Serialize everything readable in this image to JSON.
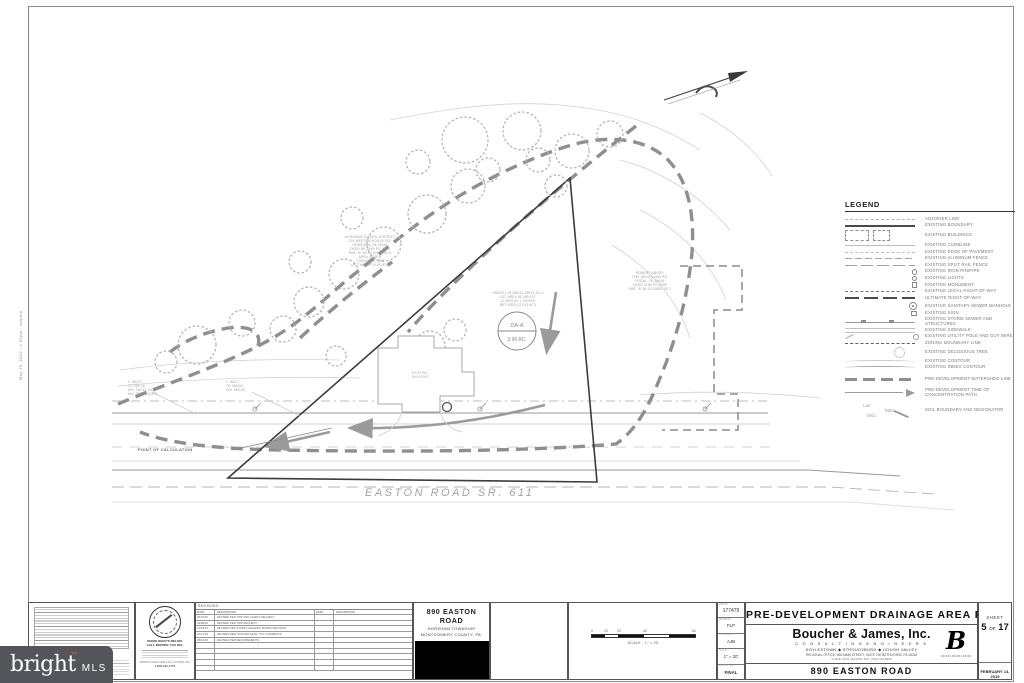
{
  "plan": {
    "road_label": "EASTON ROAD SR. 611",
    "poc_label": "POINT OF CALCULATION",
    "building": {
      "l1": "EXISTING",
      "l2": "BUILDING"
    },
    "da_circle": {
      "top": "DA-A",
      "bottom": "3.96 AC."
    },
    "school": {
      "l1": "HORSHAM SCHOOL DISTRICT",
      "l2": "229 MEETINGHOUSE RD.",
      "l3": "HORSHAM, PA 19044",
      "l4": "DEED BK 5849 PG 2644",
      "l5": "PAR. ID 36-00-10570-00-5",
      "l6": "AREA UNDER",
      "l7": "CONSTRUCTION",
      "l8": "(AT TIME OF SURVEY)"
    },
    "neighbor": {
      "l1": "ROBERT AMORY",
      "l2": "7494 WOODLAND RD.",
      "l3": "RYDAL, PA 19046",
      "l4": "DEED 5789 PG 0299",
      "l5": "PAR. ID 36-00-03897-00-2"
    },
    "parcel": {
      "l1": "PARCEL ID #36-00-03971-00-4",
      "l2": "LOT AREA 91,059 S.F.",
      "l3": "(2.0905 AC.) GROSS",
      "l4": "NET AREA (2.013 AC.)"
    },
    "inlet_left": {
      "l1": "1' INLET",
      "l2": "TG 368.26",
      "l3": "INV. 363.67 (IN)",
      "l4": "INV. 363.56 (OUT)"
    },
    "inlet_right": {
      "l1": "1' INLET",
      "l2": "TG 368.84",
      "l3": "INV. 364.43"
    },
    "file_stamp": "May 29, 2019 - 1:05pm - mcphie"
  },
  "legend": {
    "title": "LEGEND",
    "items": [
      {
        "label": "ADJOINER LINE"
      },
      {
        "label": "EXISTING BOUNDARY"
      },
      {
        "label": "EXISTING BUILDINGS"
      },
      {
        "label": "EXISTING CURBLINE"
      },
      {
        "label": "EXISTING EDGE OF PAVEMENT"
      },
      {
        "label": "EXISTING ALUMINUM FENCE"
      },
      {
        "label": "EXISTING SPLIT RAIL FENCE"
      },
      {
        "label": "EXISTING IRON PIN/PIPE"
      },
      {
        "label": "EXISTING LIGHTS"
      },
      {
        "label": "EXISTING MONUMENT"
      },
      {
        "label": "EXISTING LEGAL RIGHT-OF-WAY"
      },
      {
        "label": "ULTIMATE RIGHT-OF-WAY"
      },
      {
        "label": "EXISTING SANITARY SEWER MANHOLE"
      },
      {
        "label": "EXISTING SIGN"
      },
      {
        "label": "EXISTING STORM SEWER AND STRUCTURES"
      },
      {
        "label": "EXISTING SIDEWALK"
      },
      {
        "label": "EXISTING UTILITY POLE AND GUY WIRE"
      },
      {
        "label": "ZONING BOUNDARY LINE"
      },
      {
        "label": "EXISTING DECIDUOUS TREE"
      },
      {
        "label": "EXISTING CONTOUR"
      },
      {
        "label": "EXISTING INDEX CONTOUR"
      },
      {
        "label": "PRE-DEVELOPMENT WATERSHED LINE"
      },
      {
        "label": "PRE-DEVELOPMENT TIME OF CONCENTRATION PATH"
      },
      {
        "label": "SOIL BOUNDARY AND DESIGNATOR"
      }
    ],
    "soil": {
      "a": "LaC",
      "b": "MbC",
      "c": "MsC"
    }
  },
  "revisions": {
    "title": "REVISIONS:",
    "col_date": "DATE",
    "col_desc": "DESCRIPTION",
    "rows": [
      {
        "date": "05/01/19",
        "desc": "REVISED PER TWP AND CLIENT REQUEST"
      },
      {
        "date": "03/08/19",
        "desc": "REVISED PER TWP REQUEST"
      },
      {
        "date": "01/25/19",
        "desc": "REVISED PER ZONING HEARING BOARD DECISION"
      },
      {
        "date": "10/17/18",
        "desc": "REVISED PER TWP AND FINAL TOC COMMENTS"
      },
      {
        "date": "08/16/18",
        "desc": "REVISED PER REQUIREMENTS"
      }
    ]
  },
  "onecall": {
    "know": "KNOW WHAT'S BELOW.",
    "call": "CALL BEFORE YOU DIG.",
    "org": "PENNSYLVANIA ONE CALL SYSTEM, INC.",
    "phone": "1-800-242-1776"
  },
  "project_box": {
    "l1": "890 EASTON ROAD",
    "l2": "HORSHAM TOWNSHIP",
    "l3": "MONTGOMERY COUNTY, PA."
  },
  "scalebar": {
    "t0": "0",
    "t1": "10",
    "t2": "20",
    "t3": "40",
    "t4": "60",
    "caption": "SCALE : 1\" = 20'"
  },
  "info": {
    "job_label": "JOB NO.",
    "job": "177479",
    "drawn_label": "DRAWN BY:",
    "drawn": "FLP",
    "checked_label": "CHECKED BY:",
    "checked": "AJB",
    "scale_label": "SCALE:",
    "scale": "1\" = 20'",
    "status_label": "PLOT STYLE:",
    "status": "FINAL"
  },
  "titleblock": {
    "main_title": "PRE-DEVELOPMENT DRAINAGE AREA PLAN",
    "firm": "Boucher & James, Inc.",
    "firm_sub": "C O N S U L T I N G   E N G I N E E R S",
    "offices": "DOYLESTOWN ◆ STROUDSBURG ◆ LEHIGH VALLEY",
    "address": "REGIONAL OFFICE: 568 MAIN STREET, SUITE 230 BETHLEHEM, PA 18018",
    "phone": "VOICE: (610) 419-8407   FAX: (610) 419-8408",
    "logo": "B",
    "project": "890 EASTON ROAD",
    "sheet_label": "SHEET",
    "sheet_no": "5",
    "sheet_of": "OF",
    "sheet_total": "17",
    "date": "FEBRUARY 14, 2019"
  },
  "watermark": {
    "brand": "bright",
    "tm": "™",
    "suffix": "MLS",
    "accent": "#e2603c",
    "bg": "#54555a"
  }
}
